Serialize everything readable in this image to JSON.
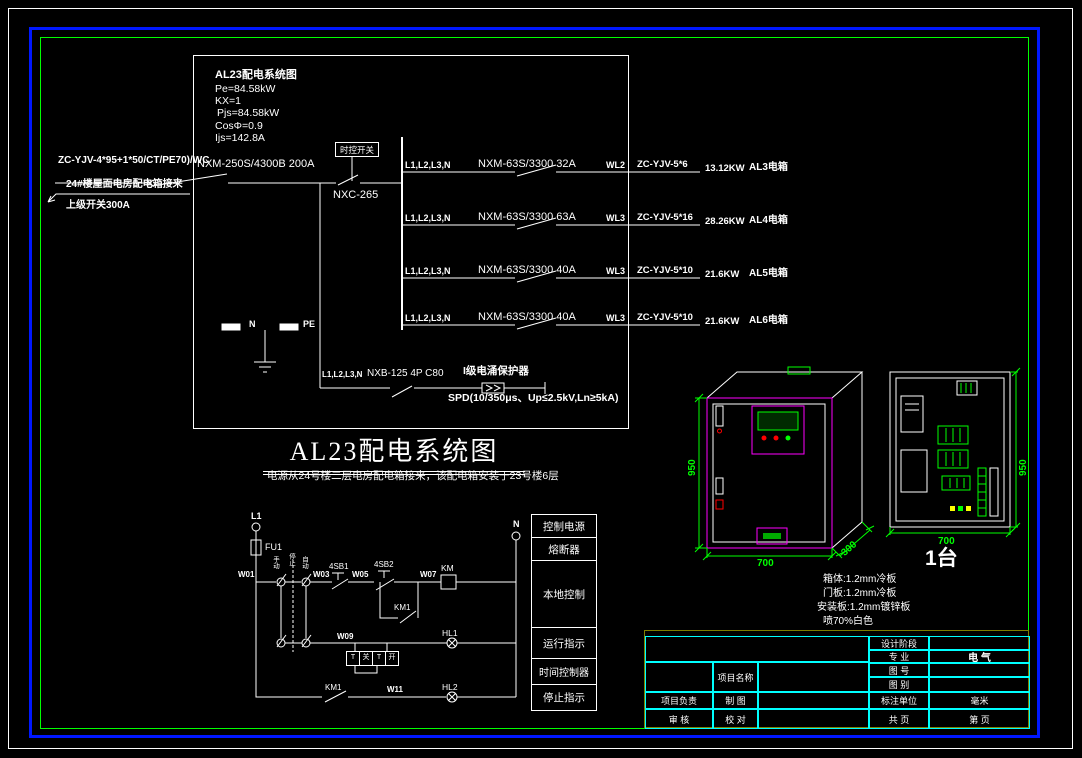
{
  "schematic": {
    "info": {
      "title": "AL23配电系统图",
      "lines": [
        "Pe=84.58kW",
        "KX=1",
        "Pjs=84.58kW",
        "CosΦ=0.9",
        "Ijs=142.8A"
      ]
    },
    "incoming": {
      "cable": "ZC-YJV-4*95+1*50/CT/PE70)/WC",
      "breaker": "NXM-250S/4300B 200A",
      "source": "24#楼屋面电房配电箱接来",
      "upstream": "上级开关300A",
      "time_switch": "时控开关",
      "contactor": "NXC-265"
    },
    "branches": [
      {
        "phases": "L1,L2,L3,N",
        "breaker": "NXM-63S/3300 32A",
        "circuit": "WL2",
        "cable": "ZC-YJV-5*6",
        "load": "13.12KW",
        "target": "AL3电箱"
      },
      {
        "phases": "L1,L2,L3,N",
        "breaker": "NXM-63S/3300 63A",
        "circuit": "WL3",
        "cable": "ZC-YJV-5*16",
        "load": "28.26KW",
        "target": "AL4电箱"
      },
      {
        "phases": "L1,L2,L3,N",
        "breaker": "NXM-63S/3300 40A",
        "circuit": "WL3",
        "cable": "ZC-YJV-5*10",
        "load": "21.6KW",
        "target": "AL5电箱"
      },
      {
        "phases": "L1,L2,L3,N",
        "breaker": "NXM-63S/3300 40A",
        "circuit": "WL3",
        "cable": "ZC-YJV-5*10",
        "load": "21.6KW",
        "target": "AL6电箱"
      }
    ],
    "spd": {
      "phases": "L1,L2,L3,N",
      "breaker": "NXB-125 4P C80",
      "name": "I级电涌保护器",
      "spec": "SPD(10/350μs、Up≤2.5kV,Ln≥5kA)"
    },
    "bars": {
      "n": "N",
      "pe": "PE"
    },
    "heading": "AL23配电系统图",
    "note": "电源从24号楼二层电房配电箱接来，该配电箱安装于23号楼6层"
  },
  "control": {
    "terminal_left": "L1",
    "terminal_right": "N",
    "fuse": "FU1",
    "selector": [
      "手动",
      "停止",
      "自动"
    ],
    "wires": {
      "w01": "W01",
      "w03": "W03",
      "w05": "W05",
      "w07": "W07",
      "w09": "W09",
      "w11": "W11"
    },
    "stop_button": "4SB1",
    "start_button": "4SB2",
    "coil": "KM",
    "seal_contact": "KM1",
    "run_lamp": "HL1",
    "stop_contact": "KM1",
    "stop_lamp": "HL2",
    "timer_cells": [
      "T",
      "关",
      "T",
      "开"
    ],
    "legend": [
      "控制电源",
      "熔断器",
      "本地控制",
      "运行指示",
      "时间控制器",
      "停止指示"
    ]
  },
  "cabinets": {
    "front": {
      "height": "950",
      "width": "700",
      "depth": "300"
    },
    "panel": {
      "height": "950",
      "width": "700"
    },
    "qty": "1台",
    "notes": [
      "箱体:1.2mm冷板",
      "门板:1.2mm冷板",
      "安装板:1.2mm镀锌板",
      "喷70%白色"
    ]
  },
  "titleblock": {
    "project_label": "项目名称",
    "design_stage": "设计阶段",
    "major_label": "专 业",
    "major_value": "电 气",
    "fig_no": "图 号",
    "fig_type": "图 别",
    "unit_label": "标注单位",
    "unit_value": "毫米",
    "total_label": "共 页",
    "page_label": "第 页",
    "pm": "项目负责",
    "draw": "制 图",
    "audit": "审 核",
    "check": "校 对"
  },
  "colors": {
    "line": "#ffffff",
    "green": "#00ff00",
    "magenta": "#ff00ff",
    "cyan": "#00ffff",
    "blue": "#0018ff",
    "olive": "#7f7f00",
    "red": "#ff0000"
  }
}
